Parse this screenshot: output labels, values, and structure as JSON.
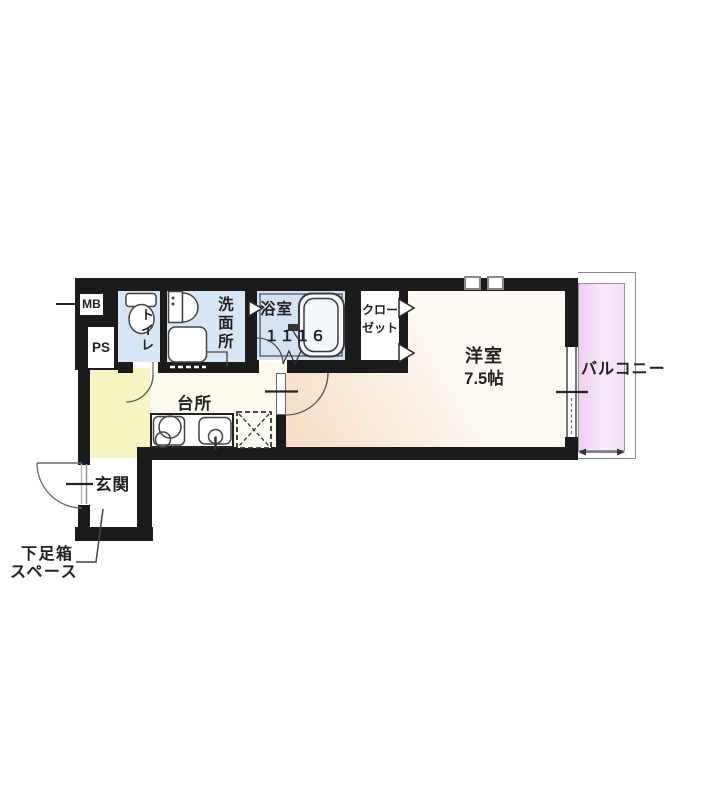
{
  "rooms": {
    "toilet": {
      "label": "トイレ"
    },
    "washroom": {
      "label": "洗面所"
    },
    "bathroom": {
      "label": "浴室",
      "size": "１１１６"
    },
    "closet": {
      "label_line1": "クロー",
      "label_line2": "ゼット"
    },
    "kitchen": {
      "label": "台所"
    },
    "western_room": {
      "label": "洋室",
      "size": "7.5帖"
    },
    "balcony": {
      "label": "バルコニー"
    },
    "entrance": {
      "label": "玄関"
    }
  },
  "labels": {
    "meter_box": "MB",
    "pipe_space": "PS",
    "shoebox_line1": "下足箱",
    "shoebox_line2": "スペース"
  },
  "colors": {
    "wall": "#1b1b1b",
    "wet": "#d7e6f4",
    "bath": "#d3e3f3",
    "yellow": "#f7f4c4",
    "hall": "#fbfaec",
    "peach": "#f6dcc3",
    "peach_l": "#fdf8f1",
    "pink": "#eecff0",
    "pink_l": "#f8eafb",
    "ink": "#222222"
  }
}
